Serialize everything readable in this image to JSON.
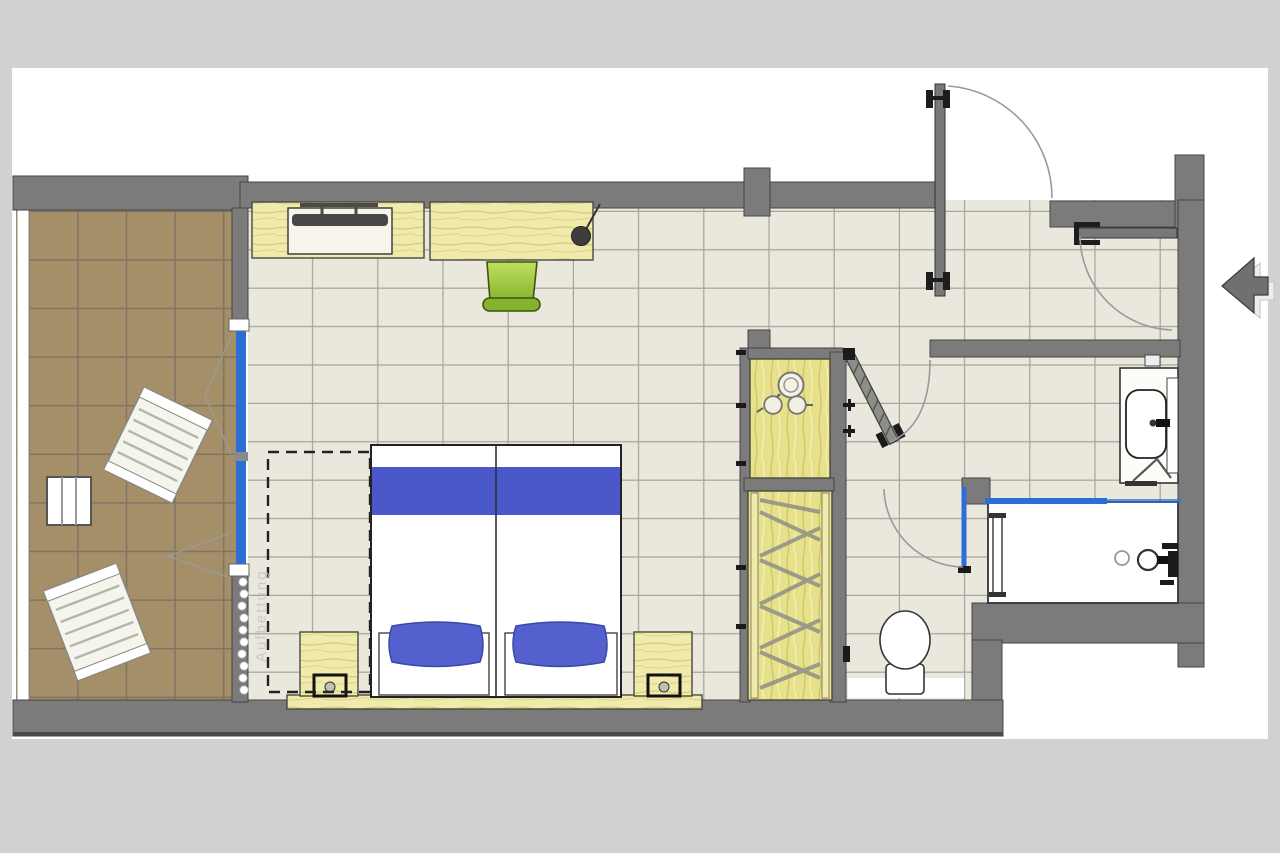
{
  "plan": {
    "extra_bed_label": "Aufbettung"
  },
  "colors": {
    "backdrop": "#d0d1d3",
    "canvas": "#ffffff",
    "wall": "#7b7b7b",
    "wall_dark": "#454545",
    "room_tile": "#eae7dc",
    "room_grout": "#a6a59b",
    "balcony_tile": "#a58f68",
    "balcony_grout": "#7c7264",
    "wood": "#f0ebad",
    "wood_streak": "#d5cc7a",
    "wood_deep": "#e7e18c",
    "wood_deep_streak": "#cdc566",
    "bed_blue": "#4a58c9",
    "pillow_blue": "#5560cf",
    "window_blue": "#2b6fd6",
    "chair_green_light": "#c0e060",
    "chair_green": "#86b32d",
    "chair_green_dark": "#3a5510",
    "tv": "#474747",
    "fixture_outline": "#333333",
    "arc": "#9a9a9a"
  },
  "symbols": [
    "balcony-lounger",
    "balcony-side-table",
    "sliding-window",
    "curtain",
    "tv-sideboard",
    "flat-screen-tv",
    "desk",
    "desk-lamp",
    "desk-chair",
    "double-bed",
    "duvet-band",
    "pillow",
    "nightstand",
    "bedside-lamp",
    "extra-bed-outline",
    "minibar-kettle",
    "minibar-cups",
    "wardrobe-hangers",
    "entrance-door",
    "door-swing-arc",
    "bathroom-door",
    "glass-shower-door",
    "toilet",
    "toilet-paper-holder",
    "washbasin",
    "towel",
    "bathtub",
    "tub-faucet",
    "towel-bar",
    "entry-direction-arrow",
    "wall-hooks"
  ]
}
